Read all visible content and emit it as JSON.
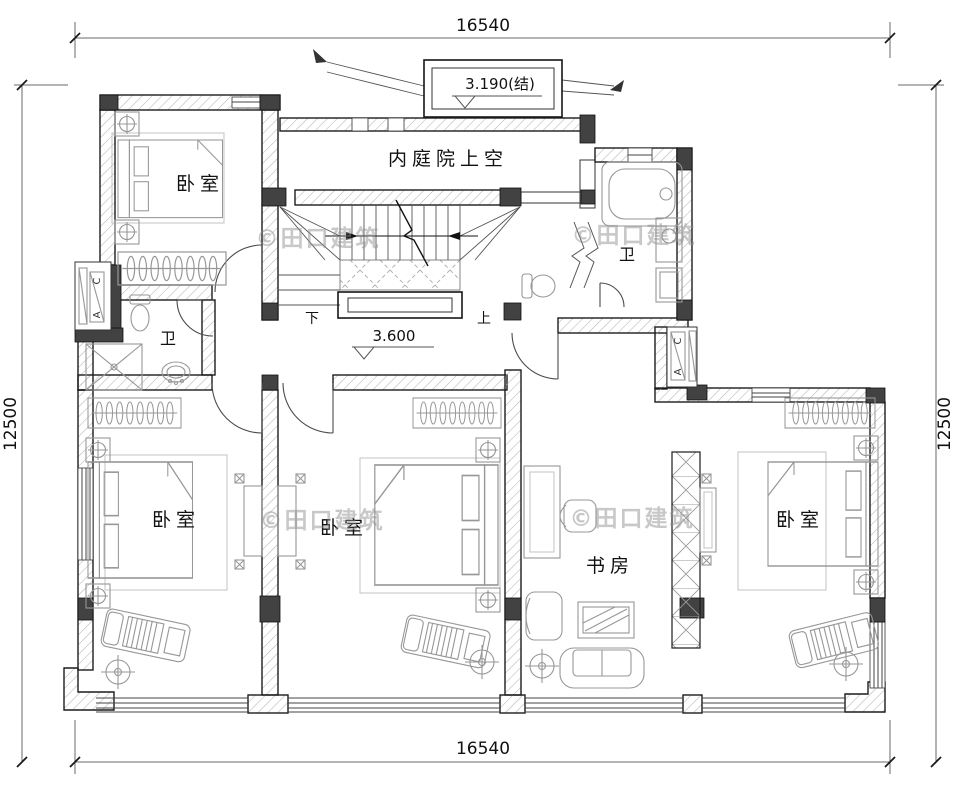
{
  "watermark": "©田口建筑",
  "dimensions": {
    "top": "16540",
    "bottom": "16540",
    "left": "12500",
    "right": "12500"
  },
  "elevations": {
    "roof_box": "3.190(结)",
    "floor": "3.600"
  },
  "rooms": {
    "courtyard": "内庭院上空",
    "bedroom_top_left": "卧室",
    "bath_left": "卫",
    "bath_right": "卫",
    "bedroom_bottom_left": "卧室",
    "bedroom_bottom_middle": "卧室",
    "study": "书房",
    "bedroom_bottom_right": "卧室"
  },
  "stairs": {
    "down": "下",
    "up": "上"
  },
  "ac_labels": {
    "c": "C",
    "a": "A"
  },
  "colors": {
    "line": "#1c1c1c",
    "hatch": "#b5b5b5",
    "column": "#424242",
    "furniture": "#979797",
    "watermark": "#8d8d8d"
  }
}
